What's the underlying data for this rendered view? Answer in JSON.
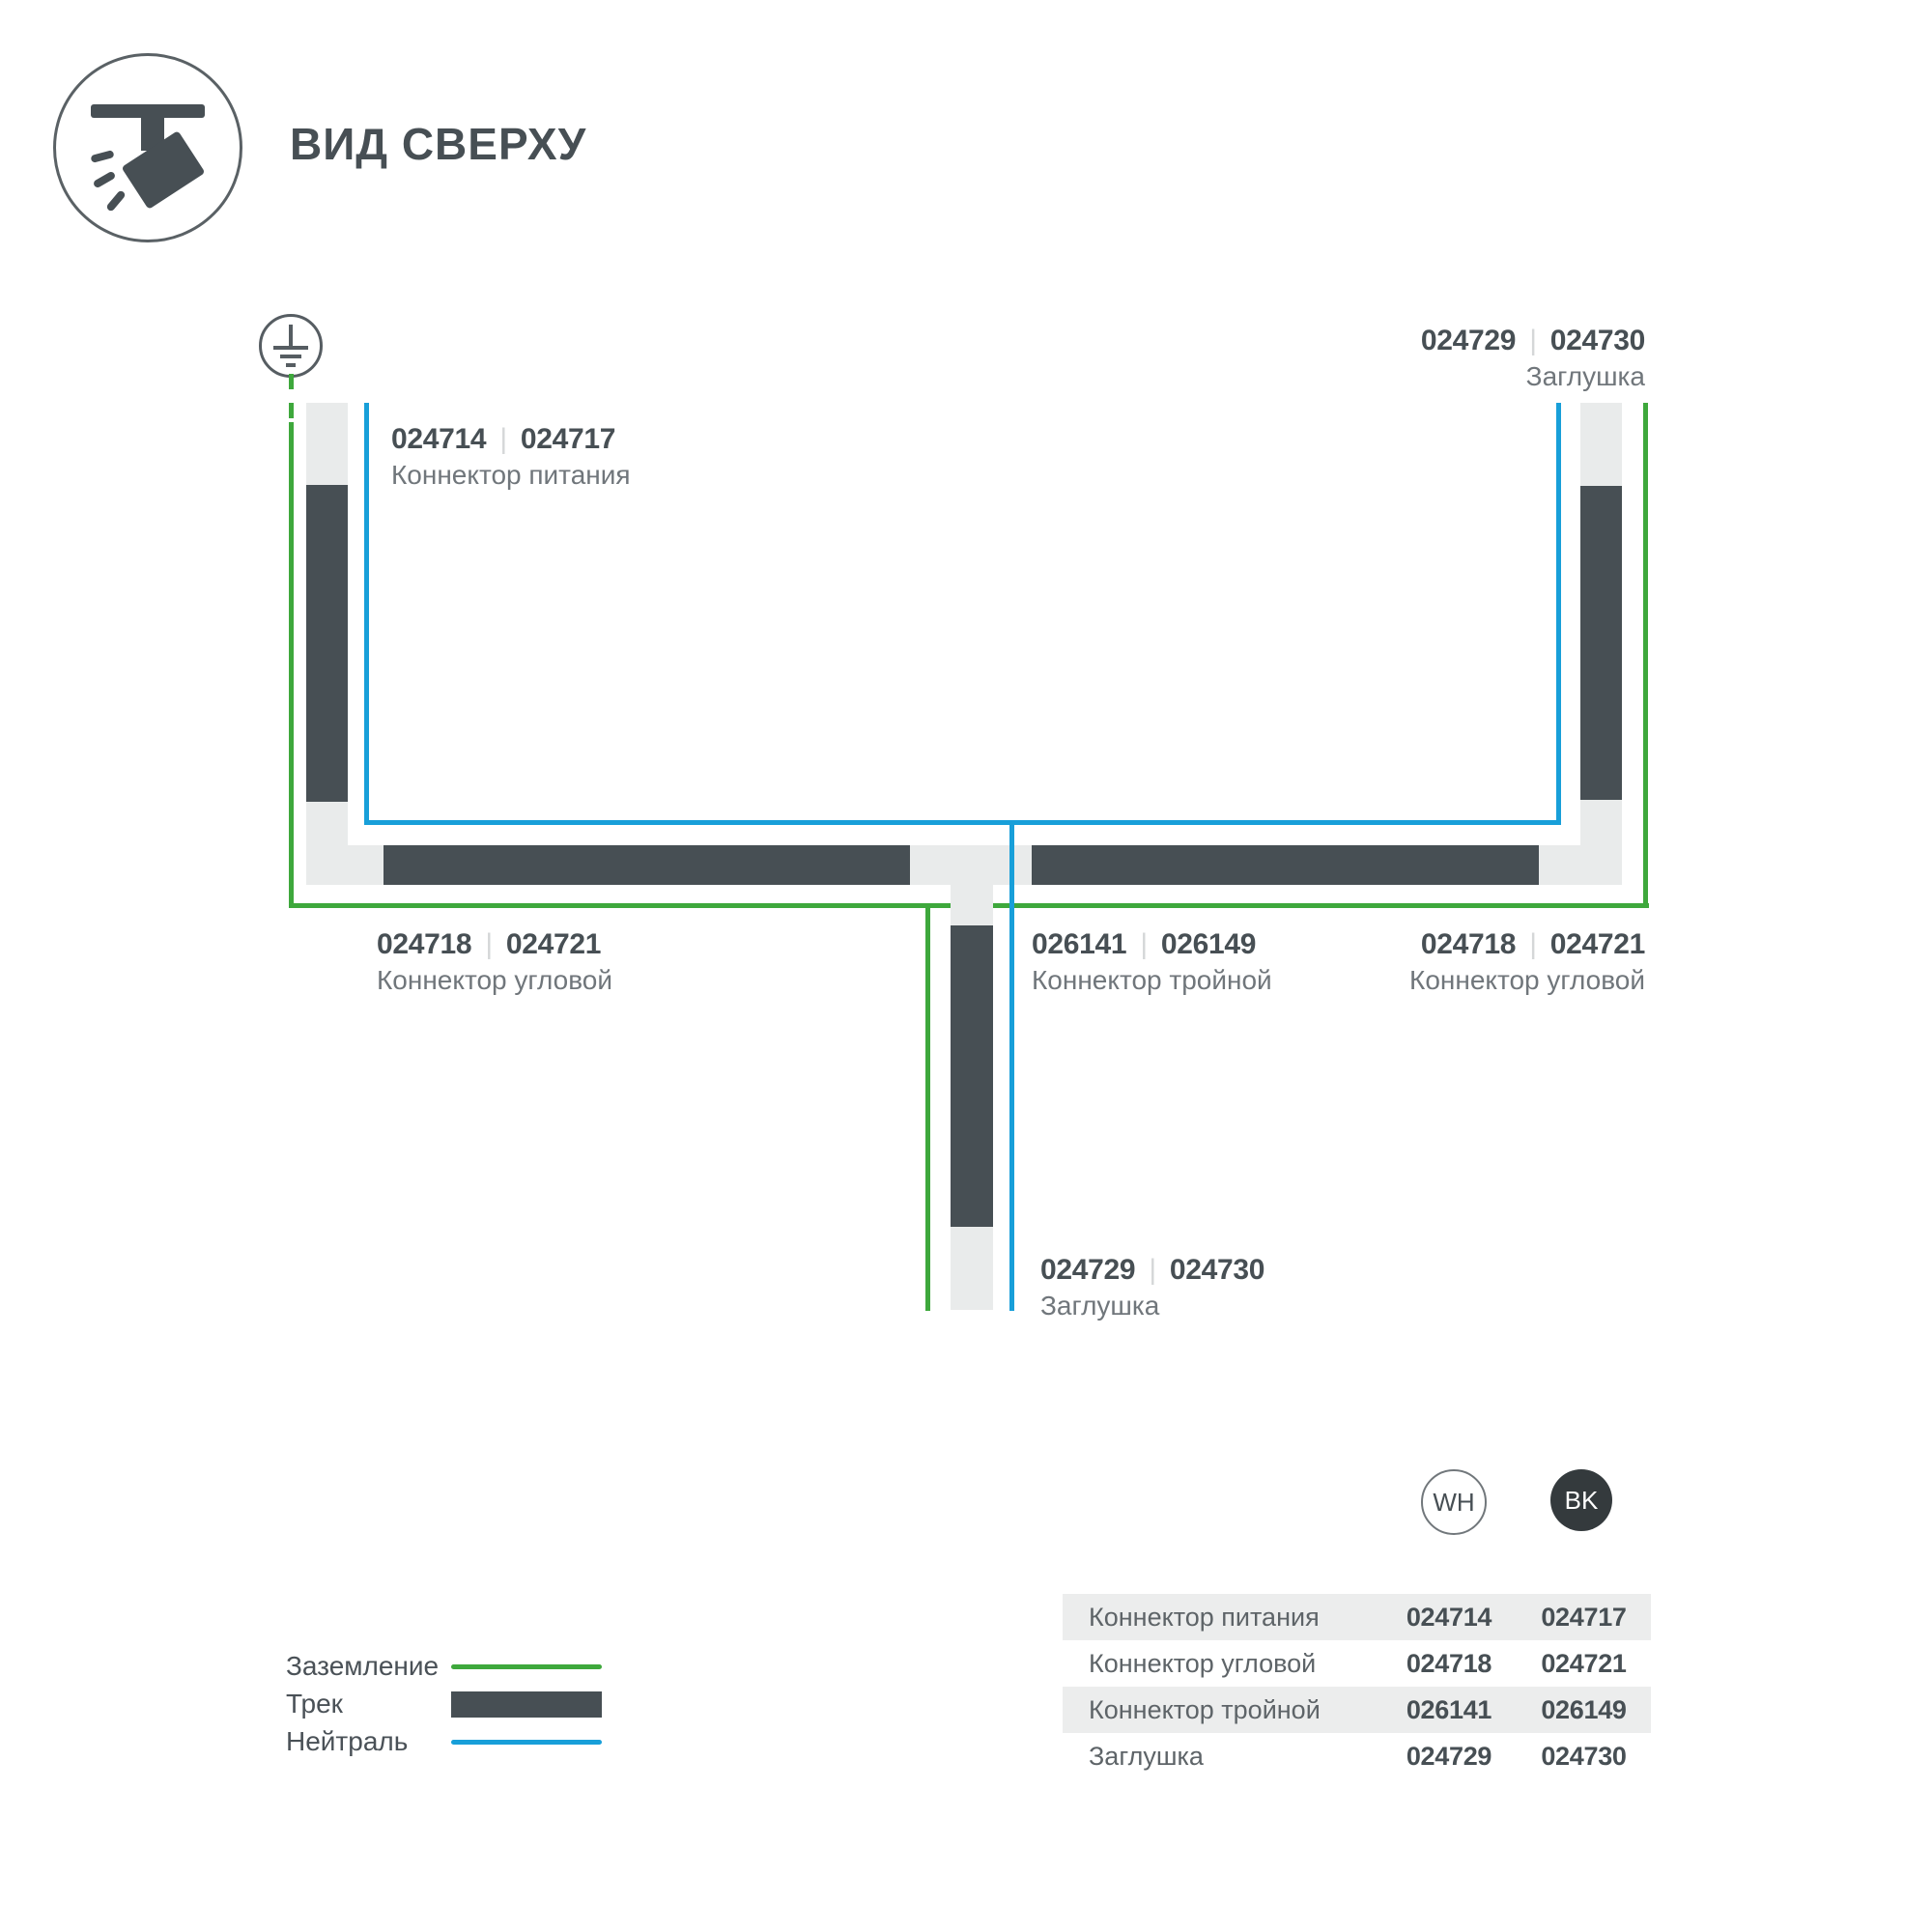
{
  "title": "ВИД СВЕРХУ",
  "divider": "|",
  "icons": {
    "header": "track-light-icon",
    "ground": "ground-earth-icon"
  },
  "colors": {
    "track": "#474F54",
    "connector": "#E9EBEB",
    "ground_line": "#3EA83C",
    "neutral_line": "#189FD9",
    "table_stripe": "#ECEDED",
    "bk_badge": "#343A3D"
  },
  "diagram": {
    "labels": {
      "power": {
        "codes": [
          "024714",
          "024717"
        ],
        "name": "Коннектор питания"
      },
      "endcap_top": {
        "codes": [
          "024729",
          "024730"
        ],
        "name": "Заглушка"
      },
      "corner_left": {
        "codes": [
          "024718",
          "024721"
        ],
        "name": "Коннектор угловой"
      },
      "tee": {
        "codes": [
          "026141",
          "026149"
        ],
        "name": "Коннектор тройной"
      },
      "corner_right": {
        "codes": [
          "024718",
          "024721"
        ],
        "name": "Коннектор угловой"
      },
      "endcap_bottom": {
        "codes": [
          "024729",
          "024730"
        ],
        "name": "Заглушка"
      }
    }
  },
  "legend": {
    "items": [
      {
        "label": "Заземление",
        "type": "ground"
      },
      {
        "label": "Трек",
        "type": "track"
      },
      {
        "label": "Нейтраль",
        "type": "neutral"
      }
    ]
  },
  "variants": {
    "wh": "WH",
    "bk": "BK"
  },
  "table": {
    "rows": [
      {
        "name": "Коннектор питания",
        "wh": "024714",
        "bk": "024717"
      },
      {
        "name": "Коннектор угловой",
        "wh": "024718",
        "bk": "024721"
      },
      {
        "name": "Коннектор тройной",
        "wh": "026141",
        "bk": "026149"
      },
      {
        "name": "Заглушка",
        "wh": "024729",
        "bk": "024730"
      }
    ]
  }
}
